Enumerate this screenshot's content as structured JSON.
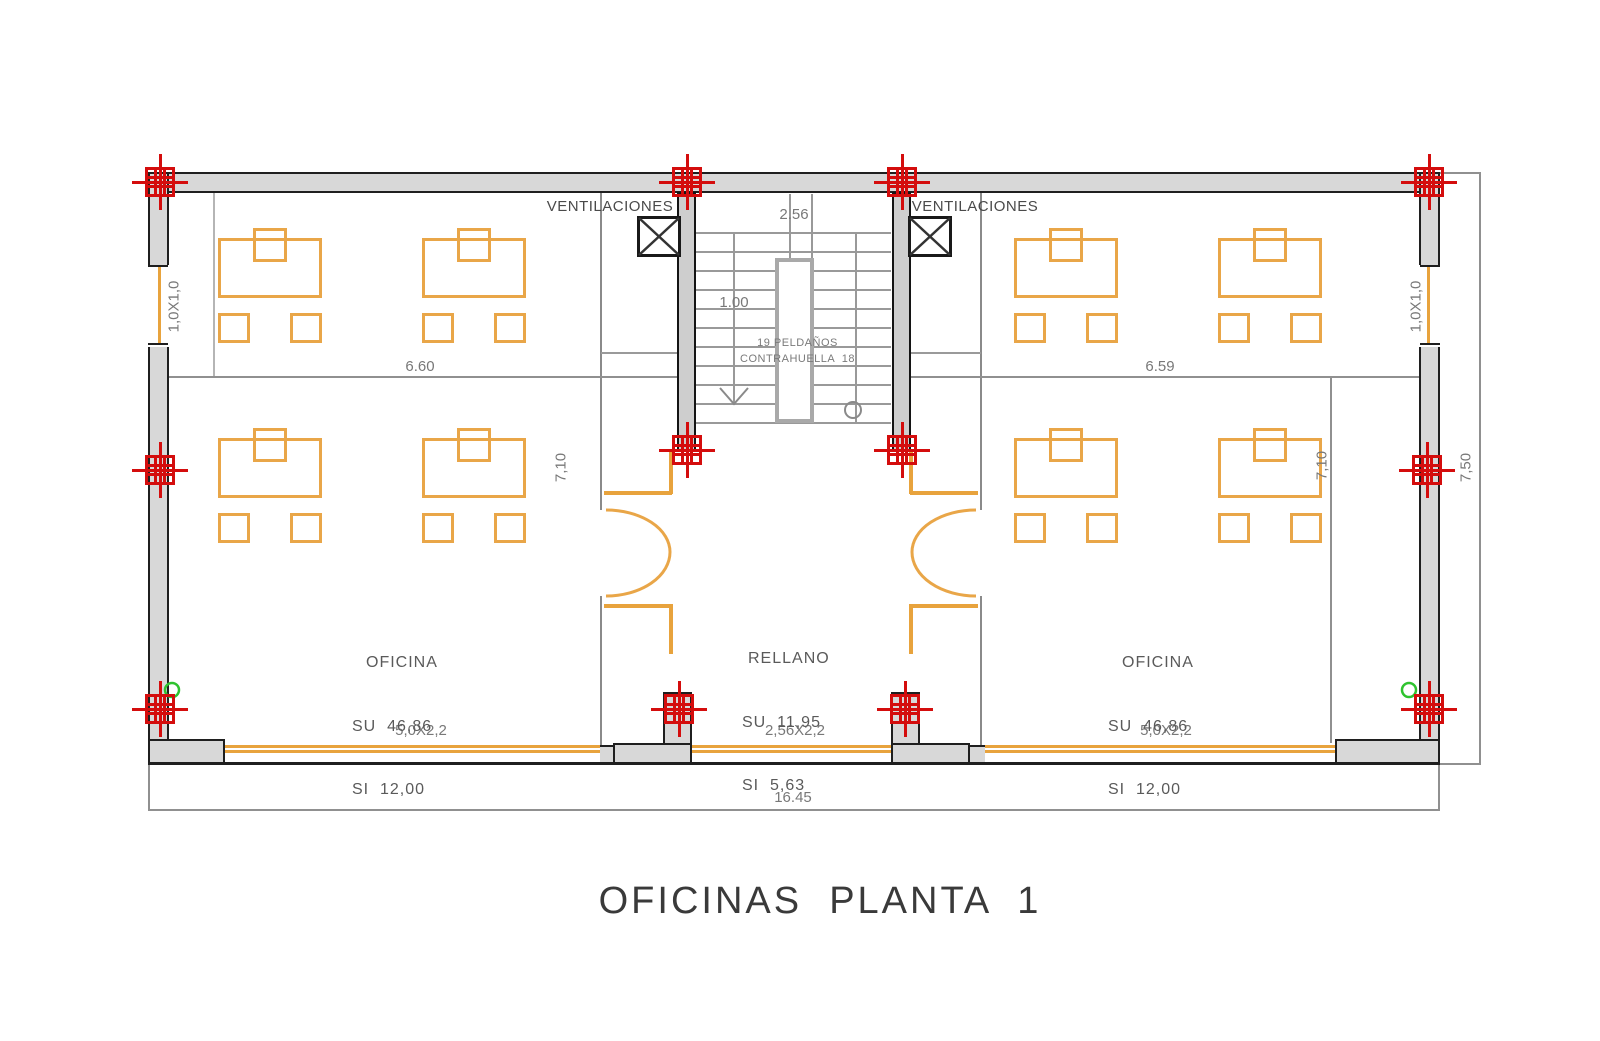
{
  "title": "OFICINAS  PLANTA  1",
  "labels": {
    "ventilaciones_left": "VENTILACIONES",
    "ventilaciones_right": "VENTILACIONES"
  },
  "rooms": {
    "office_left": {
      "name": "OFICINA",
      "su": "SU  46,86",
      "si": "SI  12,00"
    },
    "landing": {
      "name": "RELLANO",
      "su": "SU  11,95",
      "si": "SI  5,63"
    },
    "office_right": {
      "name": "OFICINA",
      "su": "SU  46,86",
      "si": "SI  12,00"
    }
  },
  "stairs": {
    "width_dim": "2.56",
    "flight_dim": "1.00",
    "note_line1": "19 PELDAÑOS",
    "note_line2": "CONTRAHUELLA  18"
  },
  "dimensions": {
    "total_width": "16.45",
    "total_height": "7,50",
    "interior_height_left": "7,10",
    "interior_height_right": "7,10",
    "office_left_width": "6.60",
    "office_right_width": "6.59",
    "window_side_left": "1,0X1,0",
    "window_side_right": "1,0X1,0",
    "window_bottom_left": "5,0X2,2",
    "window_bottom_center": "2,56X2,2",
    "window_bottom_right": "5,0X2,2"
  },
  "colors": {
    "wall_fill": "#d8d8d8",
    "furniture_orange": "#e8a33d",
    "column_red": "#d40d0d",
    "handle_green": "#2fc32f"
  }
}
